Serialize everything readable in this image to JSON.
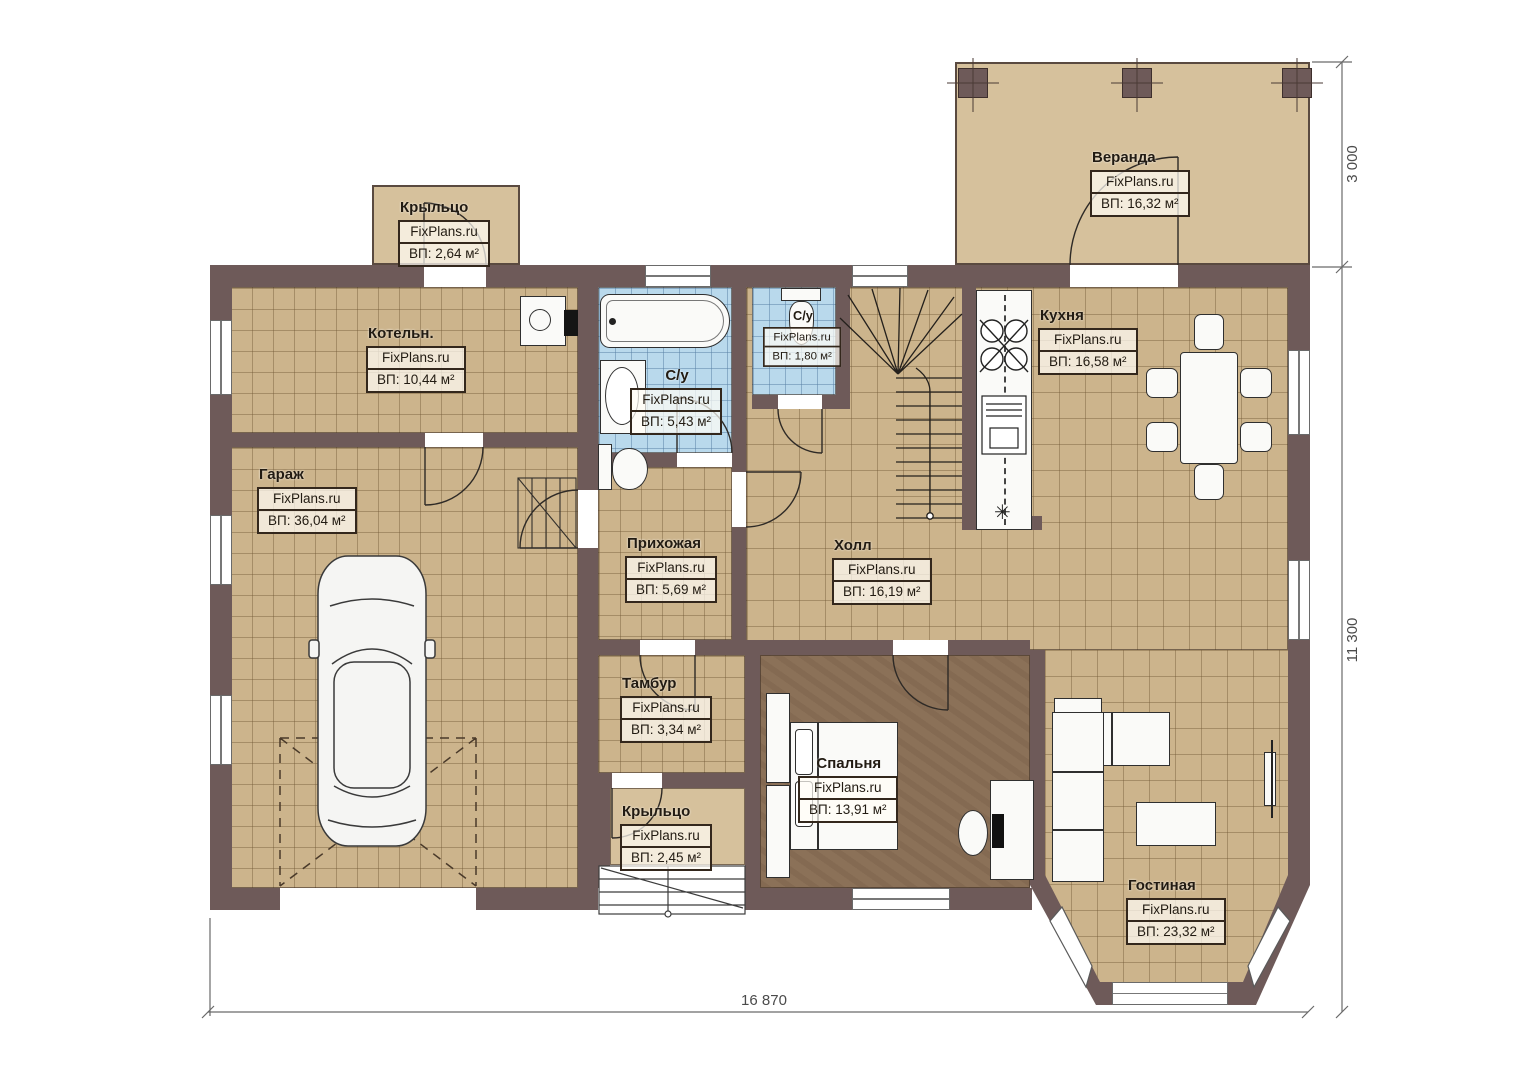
{
  "watermark": "FixPlans.ru",
  "rooms": [
    {
      "key": "veranda",
      "name": "Веранда",
      "area": "ВП: 16,32 м²"
    },
    {
      "key": "porch_top",
      "name": "Крыльцо",
      "area": "ВП: 2,64 м²"
    },
    {
      "key": "boiler",
      "name": "Котельн.",
      "area": "ВП: 10,44 м²"
    },
    {
      "key": "bathroom",
      "name": "С/у",
      "area": "ВП: 5,43 м²"
    },
    {
      "key": "wc",
      "name": "С/у",
      "area": "ВП: 1,80 м²"
    },
    {
      "key": "kitchen",
      "name": "Кухня",
      "area": "ВП: 16,58 м²"
    },
    {
      "key": "garage",
      "name": "Гараж",
      "area": "ВП: 36,04 м²"
    },
    {
      "key": "hallway",
      "name": "Прихожая",
      "area": "ВП: 5,69 м²"
    },
    {
      "key": "hall",
      "name": "Холл",
      "area": "ВП: 16,19 м²"
    },
    {
      "key": "vestibule",
      "name": "Тамбур",
      "area": "ВП: 3,34 м²"
    },
    {
      "key": "porch_bottom",
      "name": "Крыльцо",
      "area": "ВП: 2,45 м²"
    },
    {
      "key": "bedroom",
      "name": "Спальня",
      "area": "ВП: 13,91 м²"
    },
    {
      "key": "living",
      "name": "Гостиная",
      "area": "ВП: 23,32 м²"
    }
  ],
  "dimensions": {
    "bottom": "16 870",
    "right_lower": "11 300",
    "right_upper": "3 000"
  },
  "icons": {
    "fridge": "✳"
  },
  "colors": {
    "wall": "#6e5a59",
    "floor_tile": "#ccb48c",
    "floor_wet": "#b9d9ec",
    "floor_bedroom": "#8b7158",
    "floor_outdoor": "#d6c19c"
  }
}
